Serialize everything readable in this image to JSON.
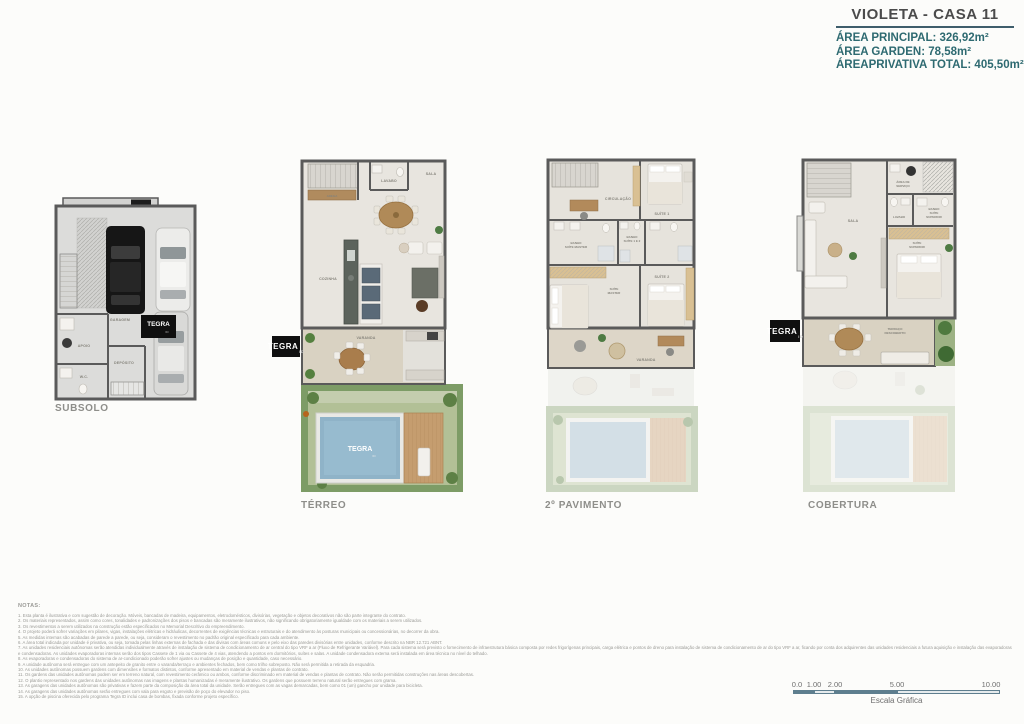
{
  "header": {
    "title": "VIOLETA - CASA 11",
    "area_principal": "ÁREA PRINCIPAL: 326,92m²",
    "area_garden": "ÁREA GARDEN: 78,58m²",
    "area_total": "ÁREAPRIVATIVA TOTAL: 405,50m²",
    "accent_color": "#2e6a71",
    "rule_color": "#3e5d6b"
  },
  "logos": {
    "tegra": "TEGRA",
    "id": "ID"
  },
  "plans": {
    "subsolo": {
      "label": "SUBSOLO",
      "rooms": {
        "garagem": "GARAGEM",
        "apoio": "APOIO",
        "deposito": "DEPÓSITO",
        "wc": "W.C."
      }
    },
    "terreo": {
      "label": "TÉRREO",
      "rooms": {
        "adega": "ADEGA",
        "cozinha": "COZINHA",
        "lavabo": "LAVABO",
        "sala": "SALA",
        "varanda": "VARANDA"
      }
    },
    "pavimento2": {
      "label": "2º PAVIMENTO",
      "rooms": {
        "circulacao": "CIRCULAÇÃO",
        "suite1": "SUÍTE 1",
        "banho_master": [
          "BANHO",
          "SUÍTE MASTER"
        ],
        "banho_s12": [
          "BANHO",
          "SUÍTE 1 E 2"
        ],
        "suite_master": [
          "SUÍTE",
          "MASTER"
        ],
        "suite2": "SUÍTE 2",
        "varanda": "VARANDA"
      }
    },
    "cobertura": {
      "label": "COBERTURA",
      "rooms": {
        "area_servico": [
          "ÁREA DE",
          "SERVIÇO"
        ],
        "lavabo": "LAVABO",
        "banho_superior": [
          "BANHO",
          "SUÍTE",
          "SUPERIOR"
        ],
        "sala": "SALA",
        "suite_superior": [
          "SUÍTE",
          "SUPERIOR"
        ],
        "terraco": [
          "TERRAÇO",
          "DESCOBERTO"
        ]
      }
    }
  },
  "notes": {
    "heading": "NOTAS:",
    "items": [
      "1. Esta planta é ilustrativa e com sugestão de decoração. Móveis, bancadas de madeira, equipamentos, eletrodomésticos, divisórias, vegetação e objetos decorativos não são parte integrante do contrato.",
      "2. Os materiais representados, assim como cores, tonalidades e padronizações dos pisos e bancadas são meramente ilustrativos, não significando obrigatoriamente igualdade com os materiais a serem utilizados.",
      "3. Os revestimentos a serem utilizados na construção estão especificados no Memorial Descritivo do empreendimento.",
      "4. O projeto poderá sofrer variações em pilares, vigas, instalações elétricas e hidráulicas, decorrentes de exigências técnicas e estruturais e do atendimento às posturas municipais ou concessionárias, no decorrer da obra.",
      "5. As medidas internas são acabadas de parede a parede, ou seja, consideram o revestimento no padrão original especificado para cada ambiente.",
      "6. A área total indicada por unidade é privativa, ou seja, tomada pelas linhas externas de fachada e das divisas com áreas comuns e pelo eixo das paredes divisórias entre unidades, conforme descrito na NBR 12.721 ABNT.",
      "7. As unidades residenciais autônomas serão atendidas individualmente através de instalação de sistema de condicionamento de ar central do tipo VRF a ar (Fluxo de Refrigerante Variável). Para cada sistema será previsto o fornecimento de infraestrutura básica composta por redes frigorígenas principais, carga elétrica e pontos de dreno para instalação de sistema de condicionamento de ar do tipo VRF a ar, ficando por conta dos adquirentes das unidades residenciais a futura aquisição e instalação das evaporadoras e condensadoras. As unidades evaporadoras internas serão dos tipos Cassete de 1 via ou Cassete de 4 vias, atendendo a pontos em dormitórios, suítes e salas. A unidade condensadora externa será instalada em área técnica no nível do telhado.",
      "8. As evaporadoras e condensadoras do sistema de ar-condicionado poderão sofrer ajustes ou mudanças de posição e quantidade, caso necessário.",
      "9. A unidade autônoma será entregue com um antepeito de granito entre o varanda/terraço e ambientes fechados, bem como trilho sobreposto. Não será permitida a retirada da esquadria.",
      "10. As unidades autônomas possuem gardens com dimensões e formatos distintos, conforme apresentado em material de vendas e plantas de contrato.",
      "11. Os gardens das unidades autônomas podem ser em terreno natural, com revestimento cerâmico ou ambos, conforme discriminado em material de vendas e plantas de contrato. Não serão permitidas construções nas áreas descobertas.",
      "12. O plantio representado nos gardens das unidades autônomas nas imagens e plantas humanizadas é meramente ilustrativo. Os gardens que possuem terreno natural serão entregues com grama.",
      "13. As garagens das unidades autônomas são privativas e fazem parte da composição da área total da unidade. Serão entregues com as vagas demarcadas, bem como 01 (um) gancho por unidade para bicicleta.",
      "14. As garagens das unidades autônomas serão entregues com vala para esgoto e previsão de poço do elevador no piso.",
      "15. A opção de piscina oferecida pelo programa Tegra ID inclui casa de bombas, fixada conforme projeto específico."
    ]
  },
  "scale": {
    "ticks": [
      "0.0",
      "1.00",
      "2.00",
      "5.00",
      "10.00"
    ],
    "label": "Escala Gráfica"
  }
}
